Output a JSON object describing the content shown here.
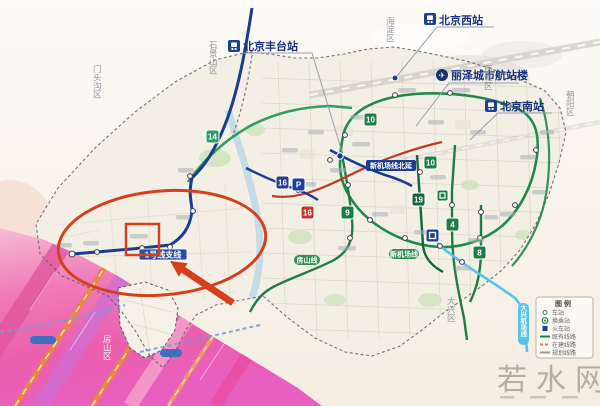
{
  "stations": {
    "fengtai": "北京丰台站",
    "beijing_west": "北京西站",
    "lize_terminal": "丽泽城市航站楼",
    "beijing_south": "北京南站"
  },
  "annotations": {
    "branch_line": "1号线支线"
  },
  "line_labels": {
    "airport_line_north_ext": "新机场线北延",
    "fangshan_line": "房山线",
    "new_airport_line": "新机场线",
    "daxing_airport_line": "大兴机场线"
  },
  "districts": {
    "mentougou": "门头沟区",
    "shijingshan": "石景山区",
    "haidian": "海淀区",
    "xicheng": "西城区",
    "chaoyang": "朝阳区",
    "daxing": "大兴区",
    "fangshan": "房山区"
  },
  "badges": [
    {
      "label": "14",
      "color": "#2f9e62"
    },
    {
      "label": "16",
      "color": "#1d3f94"
    },
    {
      "label": "P",
      "color": "#1d3f94"
    },
    {
      "label": "16",
      "color": "#c8342c"
    },
    {
      "label": "9",
      "color": "#1e7d46"
    },
    {
      "label": "10",
      "color": "#1e7d46"
    },
    {
      "label": "10",
      "color": "#1e7d46"
    },
    {
      "label": "19",
      "color": "#14663c"
    },
    {
      "label": "4",
      "color": "#1e7d46"
    },
    {
      "label": "8",
      "color": "#1e7d46"
    }
  ],
  "legend": {
    "title": "图例",
    "items": [
      {
        "label": "车站"
      },
      {
        "label": "换乘站"
      },
      {
        "label": "火车站"
      },
      {
        "label": "既有线路"
      },
      {
        "label": "在建线路"
      },
      {
        "label": "规划线路"
      }
    ]
  },
  "icons": {
    "airport_glyph": "✈"
  },
  "watermark": "若水网",
  "colors": {
    "annotation_red": "#d6401f",
    "metro_navy": "#1c3d8f",
    "metro_green": "#1f8a4d",
    "metro_crimson": "#c0392b",
    "airport_cyan": "#59c2e8",
    "highway_pink": "#ee6fae"
  }
}
